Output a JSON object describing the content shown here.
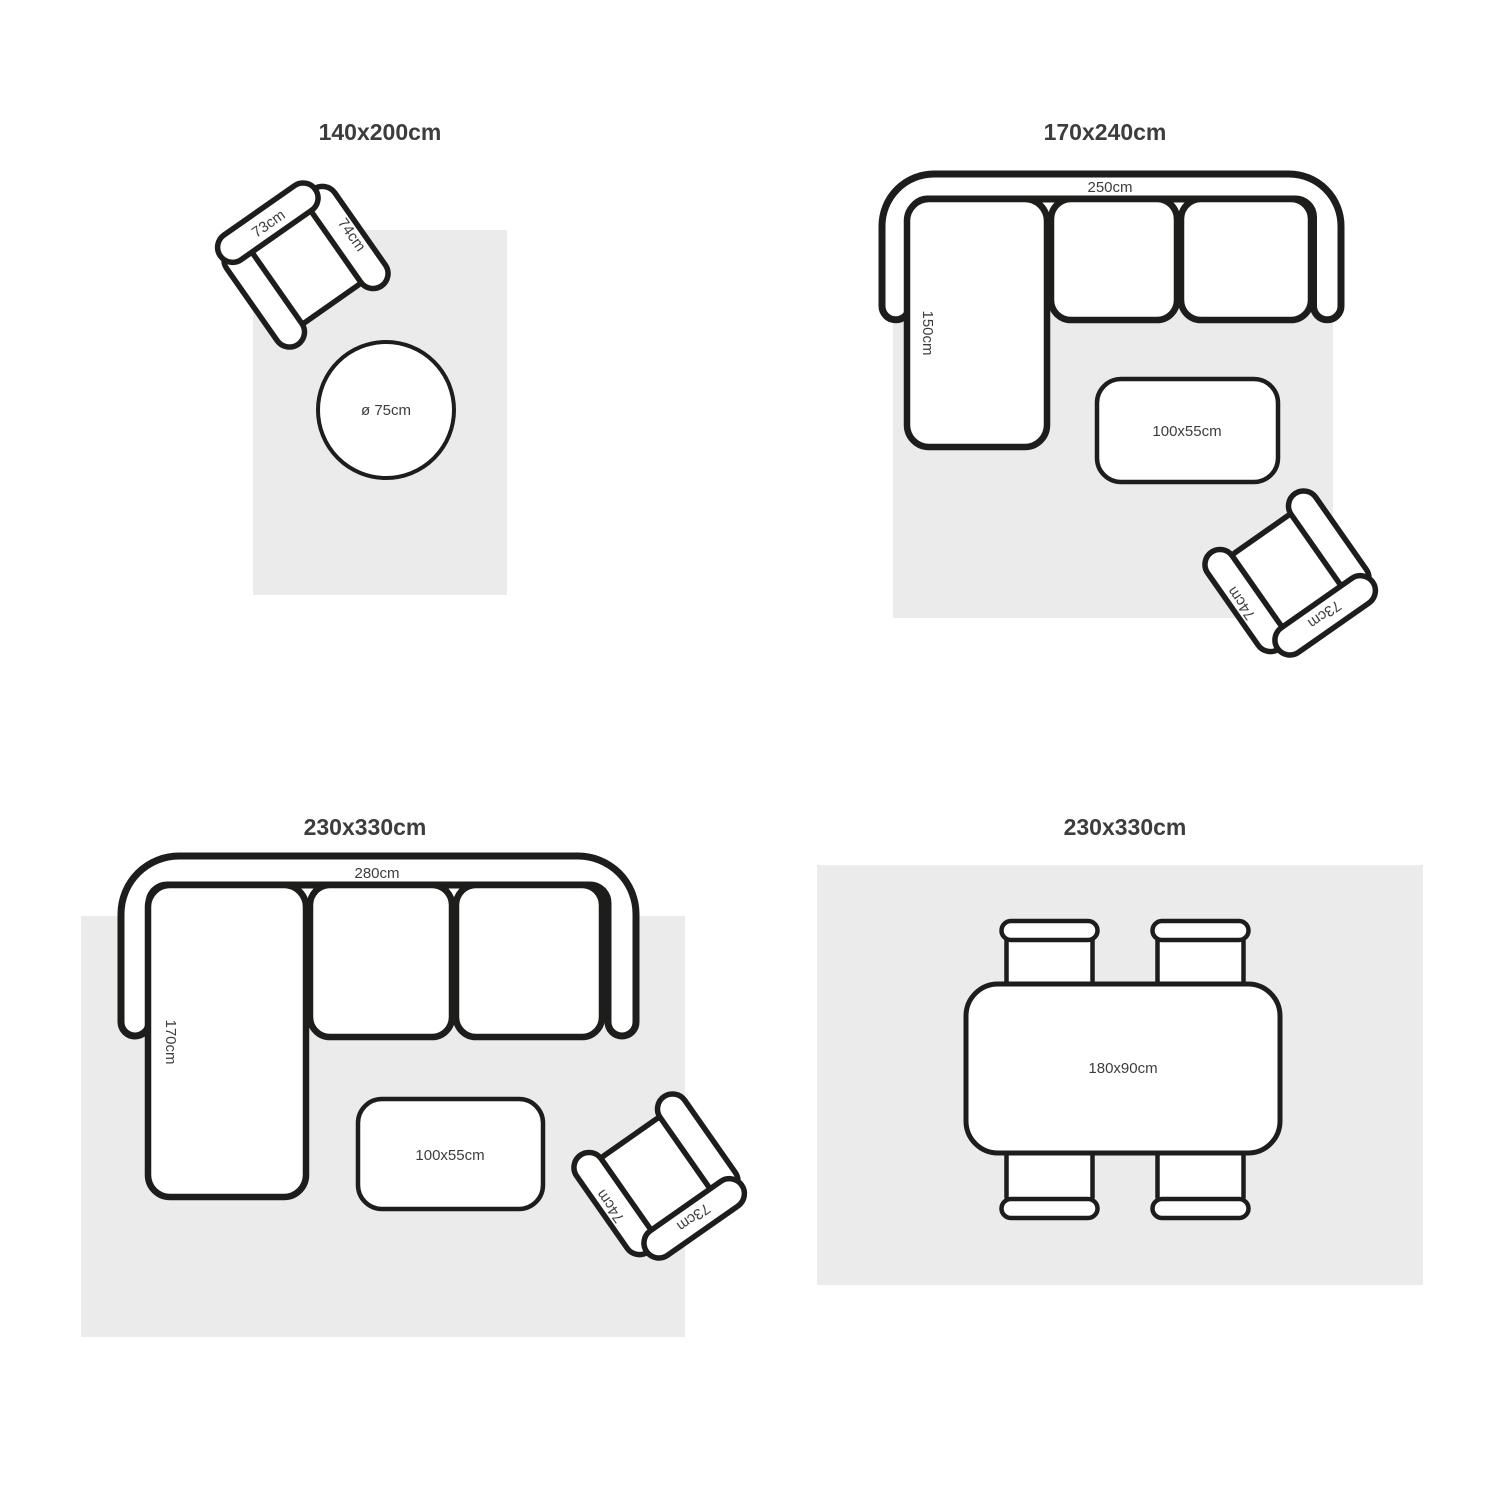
{
  "colors": {
    "background": "#ffffff",
    "rug": "#ebebeb",
    "outline": "#1d1d1b",
    "text": "#3d3d3d"
  },
  "quadrants": {
    "q1": {
      "title": "140x200cm",
      "armchair": {
        "back_label": "73cm",
        "arm_label": "74cm"
      },
      "round_table": {
        "label": "ø 75cm"
      }
    },
    "q2": {
      "title": "170x240cm",
      "sofa": {
        "width_label": "250cm",
        "chaise_label": "150cm"
      },
      "coffee_table": {
        "label": "100x55cm"
      },
      "armchair": {
        "back_label": "73cm",
        "arm_label": "74cm"
      }
    },
    "q3": {
      "title": "230x330cm",
      "sofa": {
        "width_label": "280cm",
        "chaise_label": "170cm"
      },
      "coffee_table": {
        "label": "100x55cm"
      },
      "armchair": {
        "back_label": "73cm",
        "arm_label": "74cm"
      }
    },
    "q4": {
      "title": "230x330cm",
      "dining_table": {
        "label": "180x90cm"
      }
    }
  }
}
